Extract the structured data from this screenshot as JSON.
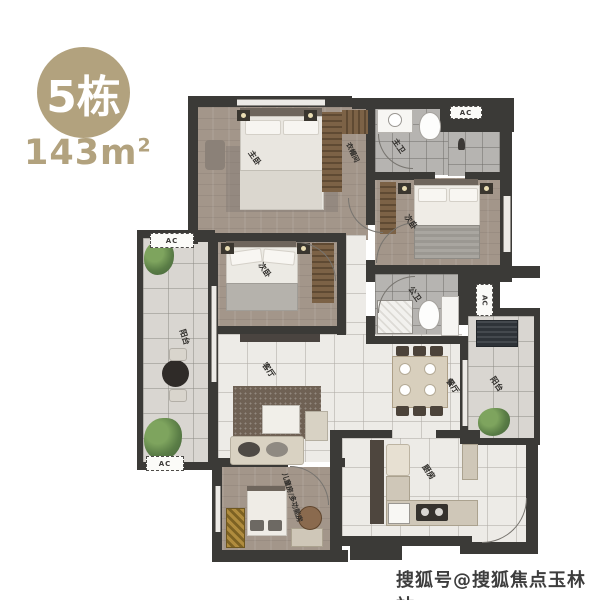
{
  "badge": {
    "building": "5栋",
    "area_base": "143m",
    "area_exp": "2"
  },
  "watermark": "搜狐号@搜狐焦点玉林站",
  "rooms": {
    "master_bedroom": {
      "label": "主卧"
    },
    "closet": {
      "label": "衣帽间"
    },
    "master_bath": {
      "label": "主卫"
    },
    "bedroom_top_right": {
      "label": "次卧"
    },
    "bedroom_mid_left": {
      "label": "次卧"
    },
    "balcony_left": {
      "label": "阳台"
    },
    "living_room": {
      "label": "客厅"
    },
    "dining_room": {
      "label": "餐厅"
    },
    "bath_second": {
      "label": "公卫"
    },
    "kitchen": {
      "label": "厨房"
    },
    "kids_room": {
      "label": "儿童房/多功能房"
    },
    "balcony_right": {
      "label": "阳台"
    }
  },
  "ac_labels": {
    "balcony_top": "AC",
    "balcony_bottom": "AC",
    "right_platform": "AC",
    "top_right": "AC"
  },
  "colors": {
    "badge": "#b2a27e",
    "wall": "#3b3a37",
    "wood_floor": "#a3968a",
    "tile_light": "#edebe7",
    "tile_gray": "#b6b4b1",
    "balcony_tile": "#d9d6d1",
    "watermark": "#3d3d3d"
  }
}
